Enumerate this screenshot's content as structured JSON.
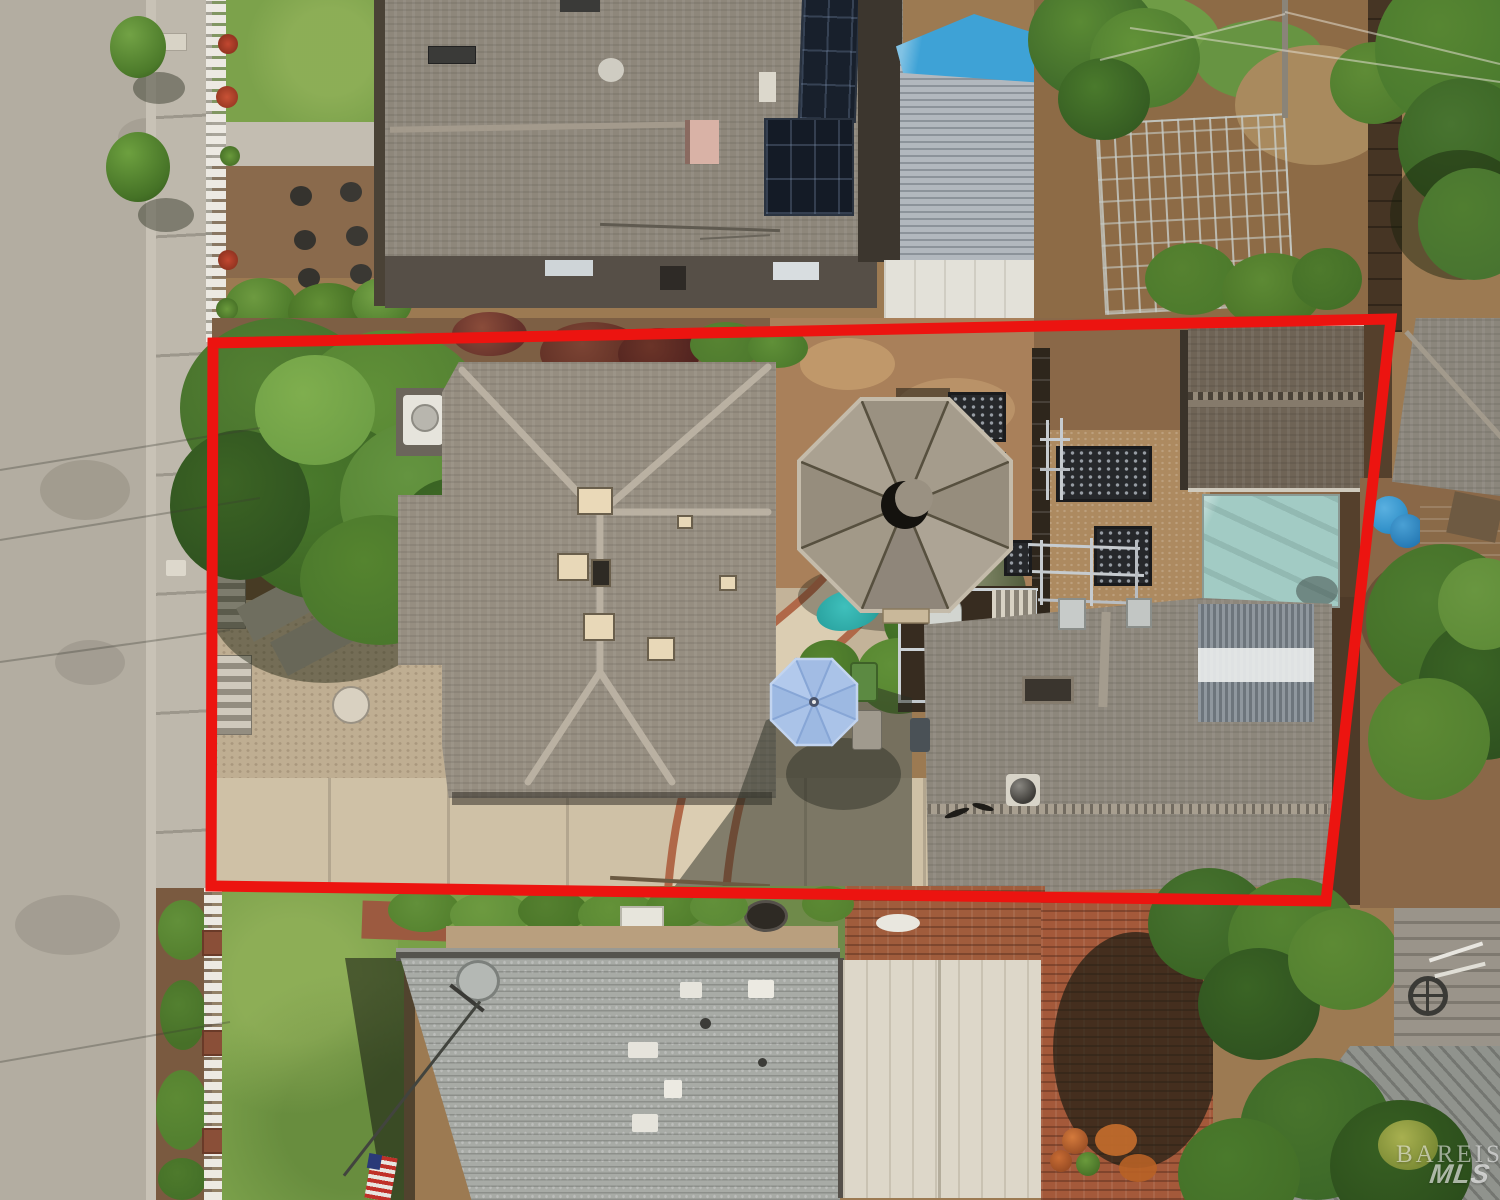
{
  "image": {
    "type": "aerial-drone-photograph",
    "subject": "residential property lot with red boundary overlay, houses, backyard gazebo, gardens and street"
  },
  "watermark": {
    "line1": "BAREIS",
    "line2": "MLS"
  },
  "overlay": {
    "boundary_color": "#ec1410"
  },
  "palette": {
    "street": "#b3ada1",
    "sidewalk": "#beb8ac",
    "lawn": "#7aa04a",
    "mulch": "#8a6848",
    "main_roof": "#968e81",
    "top_neighbor_roof": "#8e877b",
    "second_roof": "#8d877c",
    "bottom_neighbor_roof": "#a8aba6",
    "gazebo_roof": "#a59c8c",
    "umbrella_blue": "#a9c2e6",
    "tarp_teal": "#a2cbc4",
    "tarp_blue": "#3ea2d6",
    "carport": "#ddd7c9",
    "brick_patio": "#a4593a",
    "solar_panel": "#18202c",
    "shed_roof": "#6f6456",
    "tree_green": "#4e7a2c",
    "fence_white": "#ece9e2"
  },
  "scene": {
    "features": [
      "street",
      "sidewalk",
      "white-picket-fence",
      "main-house-roof",
      "gazebo",
      "raised-garden-beds",
      "shed",
      "teal-tarp",
      "second-house-roof",
      "patio-umbrella",
      "trash-bins",
      "driveway",
      "front-lawn",
      "bottom-neighbor-house",
      "satellite-dish",
      "carport",
      "brick-patio",
      "top-neighbor-house",
      "solar-panels",
      "blue-tarp",
      "vegetable-garden-trellis",
      "play-structure-slide",
      "trees",
      "red-property-boundary"
    ]
  }
}
